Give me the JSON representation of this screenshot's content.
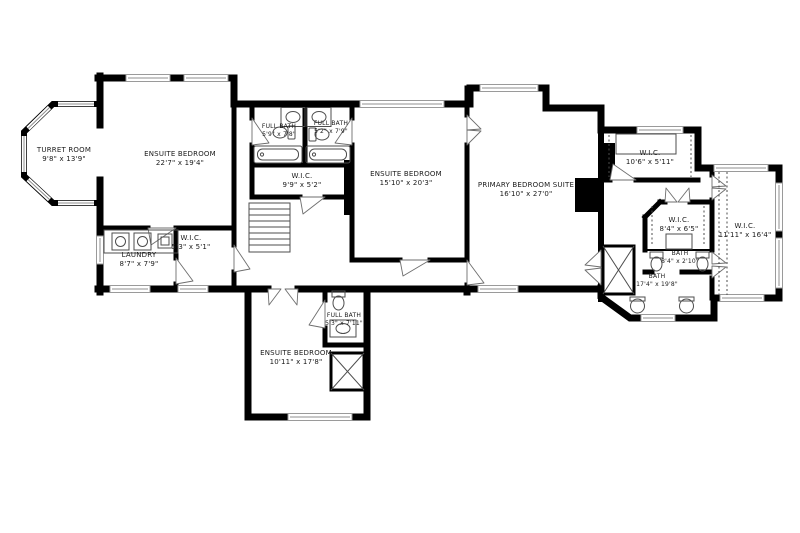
{
  "colors": {
    "walls": "#000000",
    "thin_lines": "#4d4d4d",
    "window_lines": "#8f8f8f",
    "background": "#ffffff",
    "text": "#1a1a1a"
  },
  "rooms": [
    {
      "id": "turret-room",
      "name": "TURRET ROOM",
      "dims": "9'8\" x 13'9\""
    },
    {
      "id": "ensuite-bedroom-1",
      "name": "ENSUITE BEDROOM",
      "dims": "22'7\" x 19'4\""
    },
    {
      "id": "full-bath-1",
      "name": "FULL BATH",
      "dims": "5'9\" x 7'8\""
    },
    {
      "id": "full-bath-2",
      "name": "FULL BATH",
      "dims": "5'2\" x 7'9\""
    },
    {
      "id": "wic-middle",
      "name": "W.I.C.",
      "dims": "9'9\" x 5'2\""
    },
    {
      "id": "ensuite-bedroom-2",
      "name": "ENSUITE BEDROOM",
      "dims": "15'10\" x 20'3\""
    },
    {
      "id": "primary-suite",
      "name": "PRIMARY BEDROOM SUITE",
      "dims": "16'10\" x 27'0\""
    },
    {
      "id": "wic-north",
      "name": "W.I.C.",
      "dims": "10'6\" x 5'11\""
    },
    {
      "id": "wic-inner",
      "name": "W.I.C.",
      "dims": "8'4\" x 6'5\""
    },
    {
      "id": "wic-east",
      "name": "W.I.C.",
      "dims": "11'11\" x 16'4\""
    },
    {
      "id": "bath-small",
      "name": "BATH",
      "dims": "8'4\" x 2'10\""
    },
    {
      "id": "bath-large",
      "name": "BATH",
      "dims": "17'4\" x 19'8\""
    },
    {
      "id": "laundry",
      "name": "LAUNDRY",
      "dims": "8'7\" x 7'9\""
    },
    {
      "id": "wic-laundry",
      "name": "W.I.C.",
      "dims": "5'3\" x 5'1\""
    },
    {
      "id": "full-bath-3",
      "name": "FULL BATH",
      "dims": "5'3\" x 7'11\""
    },
    {
      "id": "ensuite-bedroom-3",
      "name": "ENSUITE BEDROOM",
      "dims": "10'11\" x 17'8\""
    }
  ]
}
